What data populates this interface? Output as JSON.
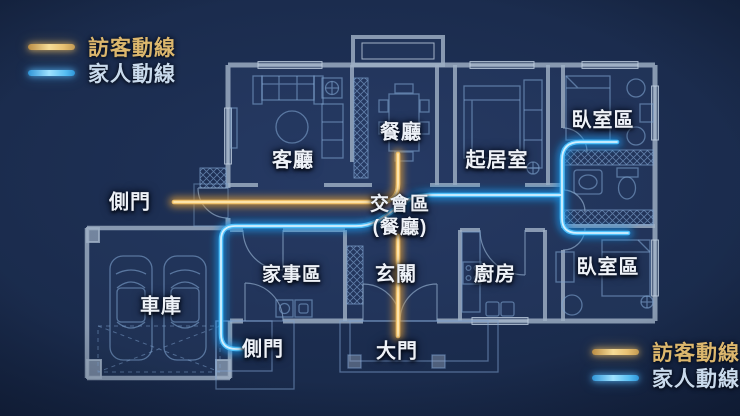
{
  "legend": {
    "visitor_label": "訪客動線",
    "family_label": "家人動線"
  },
  "rooms": {
    "living_room": "客廳",
    "dining_room": "餐廳",
    "sitting_room": "起居室",
    "bedroom_upper": "臥室區",
    "bedroom_lower": "臥室區",
    "garage": "車庫",
    "housework_area": "家事區",
    "entrance_hall": "玄關",
    "kitchen": "廚房"
  },
  "doors": {
    "side_door_left": "側門",
    "side_door_lower": "側門",
    "main_door": "大門"
  },
  "junction": {
    "line1": "交會區",
    "line2": "(餐廳)"
  },
  "colors": {
    "visitor_route": "#eec06a",
    "family_route": "#4fc0fa",
    "background": "#1a2b4c",
    "walls": "#9fb0c4",
    "furniture_lines": "#7fa3cf",
    "label_text": "#eef2f8",
    "legend_visitor_text": "#dcb76d",
    "legend_family_text": "#c9daec"
  }
}
